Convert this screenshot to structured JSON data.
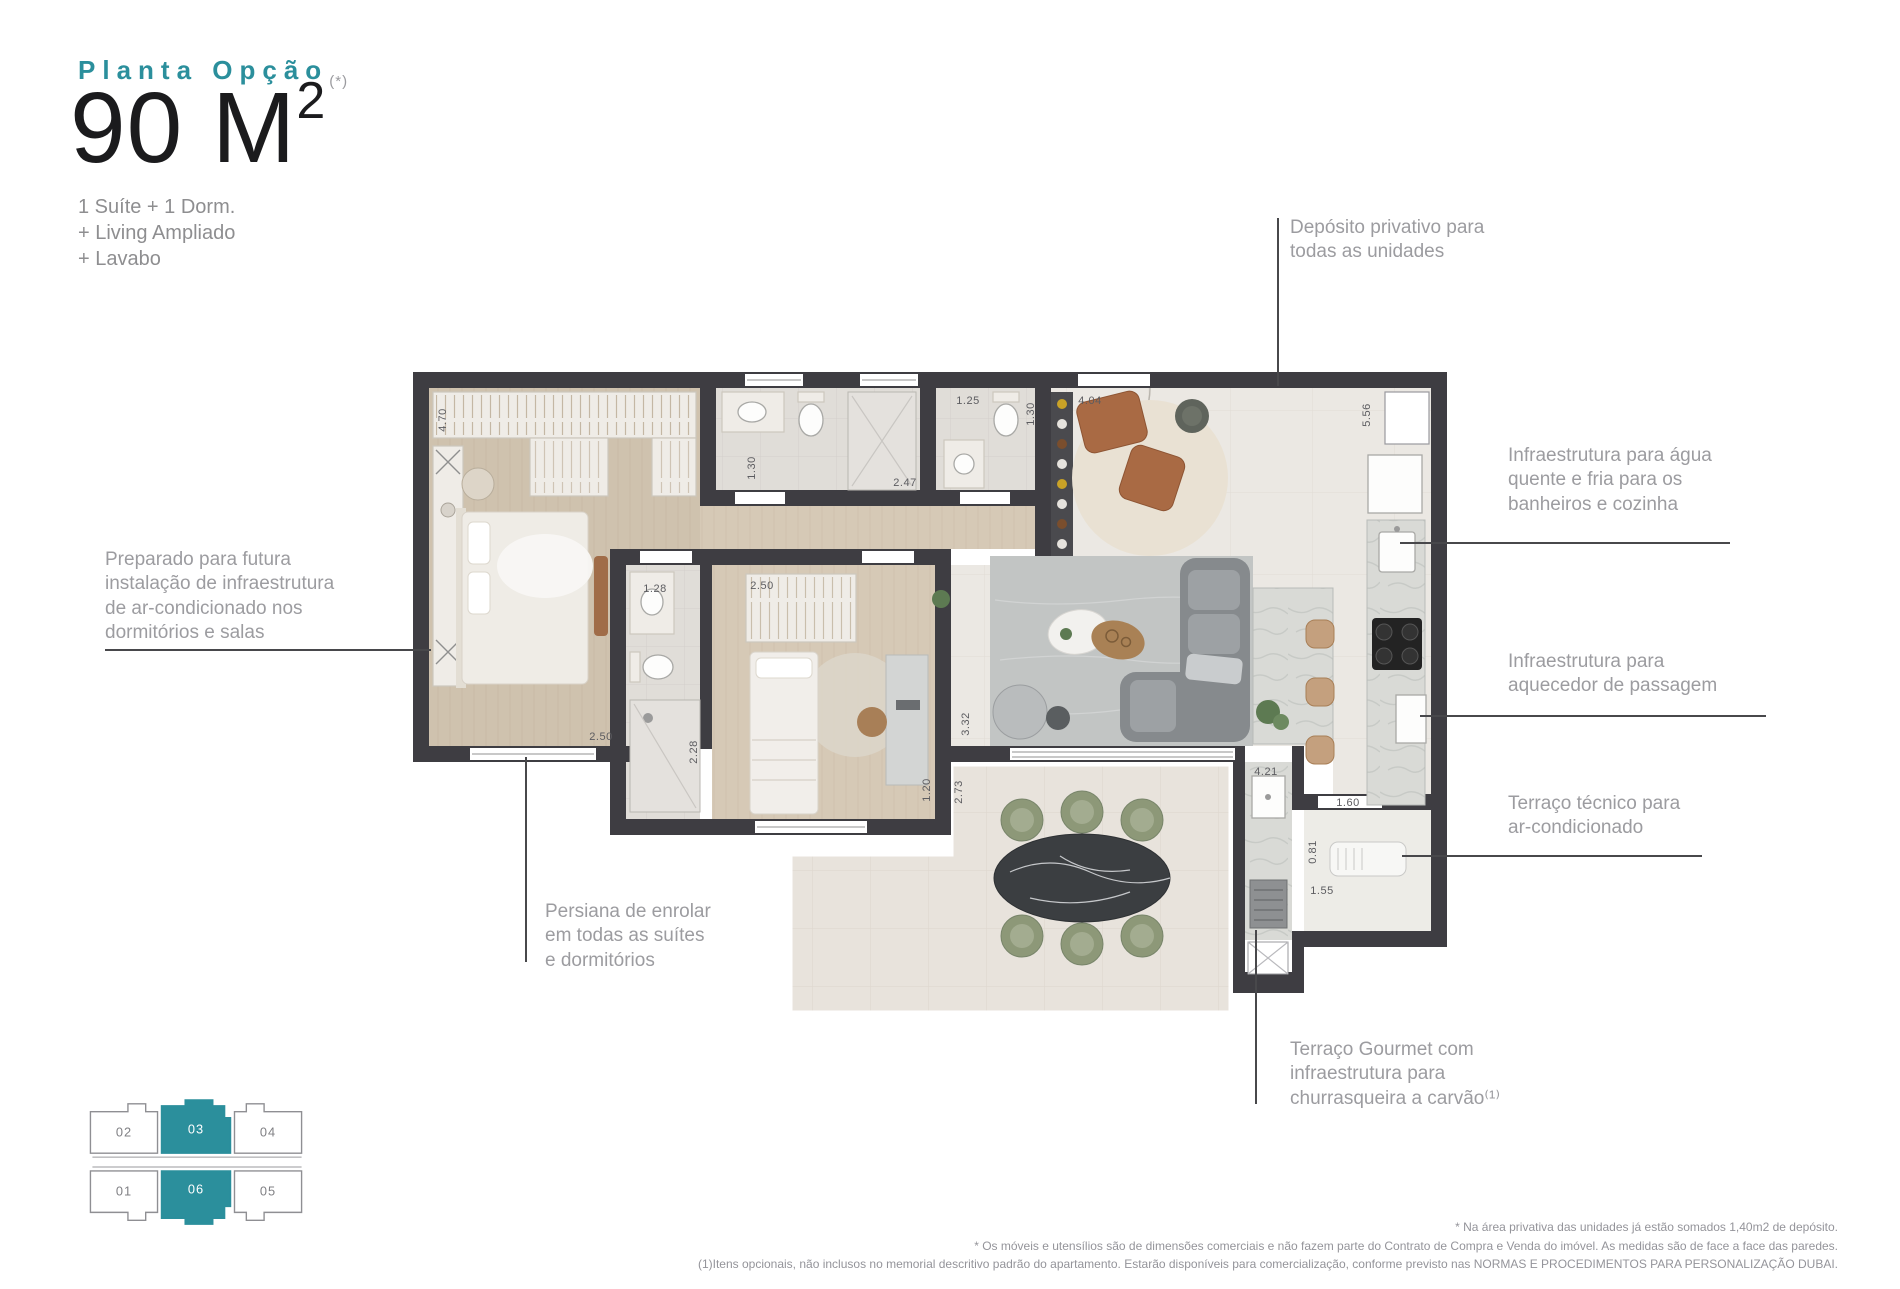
{
  "header": {
    "eyebrow": "Planta Opção",
    "area_value": "90 M",
    "area_sup": "2",
    "area_note": "(*)",
    "features": "1 Suíte + 1 Dorm.\n+ Living Ampliado\n+ Lavabo"
  },
  "annotations": {
    "deposito": "Depósito privativo para\ntodas as unidades",
    "agua": "Infraestrutura para água\nquente e fria para os\nbanheiros e cozinha",
    "aquecedor": "Infraestrutura para\naquecedor de passagem",
    "terraco_tecnico": "Terraço técnico para\nar-condicionado",
    "ac_prep": "Preparado para futura\ninstalação de infraestrutura\nde ar-condicionado nos\ndormitórios e salas",
    "persiana": "Persiana de enrolar\nem todas as suítes\ne dormitórios",
    "terraco_gourmet": "Terraço Gourmet com\ninfraestrutura para\nchurrasqueira a carvão⁽¹⁾"
  },
  "plan": {
    "dims": {
      "d470": "4.70",
      "d130a": "1.30",
      "d247": "2.47",
      "d125": "1.25",
      "d130b": "1.30",
      "d404": "4.04",
      "d556": "5.56",
      "d128": "1.28",
      "d250a": "2.50",
      "d228": "2.28",
      "d250b": "2.50",
      "d120": "1.20",
      "d332": "3.32",
      "d273": "2.73",
      "d421": "4.21",
      "d160": "1.60",
      "d081": "0.81",
      "d155": "1.55"
    }
  },
  "keyplan": {
    "units": [
      {
        "label": "02",
        "fill": "#ffffff",
        "stroke": "#8f8f93",
        "label_fill": "#808084",
        "highlighted": false
      },
      {
        "label": "03",
        "fill": "#2b8f9c",
        "stroke": "#2b8f9c",
        "label_fill": "#ffffff",
        "highlighted": true
      },
      {
        "label": "04",
        "fill": "#ffffff",
        "stroke": "#8f8f93",
        "label_fill": "#808084",
        "highlighted": false
      },
      {
        "label": "01",
        "fill": "#ffffff",
        "stroke": "#8f8f93",
        "label_fill": "#808084",
        "highlighted": false
      },
      {
        "label": "06",
        "fill": "#2b8f9c",
        "stroke": "#2b8f9c",
        "label_fill": "#ffffff",
        "highlighted": true
      },
      {
        "label": "05",
        "fill": "#ffffff",
        "stroke": "#8f8f93",
        "label_fill": "#808084",
        "highlighted": false
      }
    ]
  },
  "footer": {
    "lines": "* Na área privativa das unidades já estão somados 1,40m2 de depósito.\n* Os móveis e utensílios são de dimensões comerciais e não fazem parte do Contrato de Compra e Venda do imóvel. As medidas são de face a face das paredes.\n(1)Itens opcionais, não inclusos no memorial descritivo padrão do apartamento. Estarão disponíveis para comercialização, conforme previsto nas NORMAS E PROCEDIMENTOS PARA PERSONALIZAÇÃO DUBAI."
  },
  "colors": {
    "accent": "#2b8f9c",
    "wall": "#3e3d42",
    "annotation_text": "#9c9ca0",
    "dim_text": "#5c5c60",
    "title_text": "#1b1b1d",
    "subtitle_text": "#8e8e90",
    "footnote_text": "#94949a",
    "wood_floor": "#cfc2ae",
    "tile_floor": "#ebe8e3",
    "terrace_chair": "#8d9878",
    "marble_table": "#3b3e41",
    "leather_chair": "#a96a44",
    "sofa": "#868a8d"
  }
}
